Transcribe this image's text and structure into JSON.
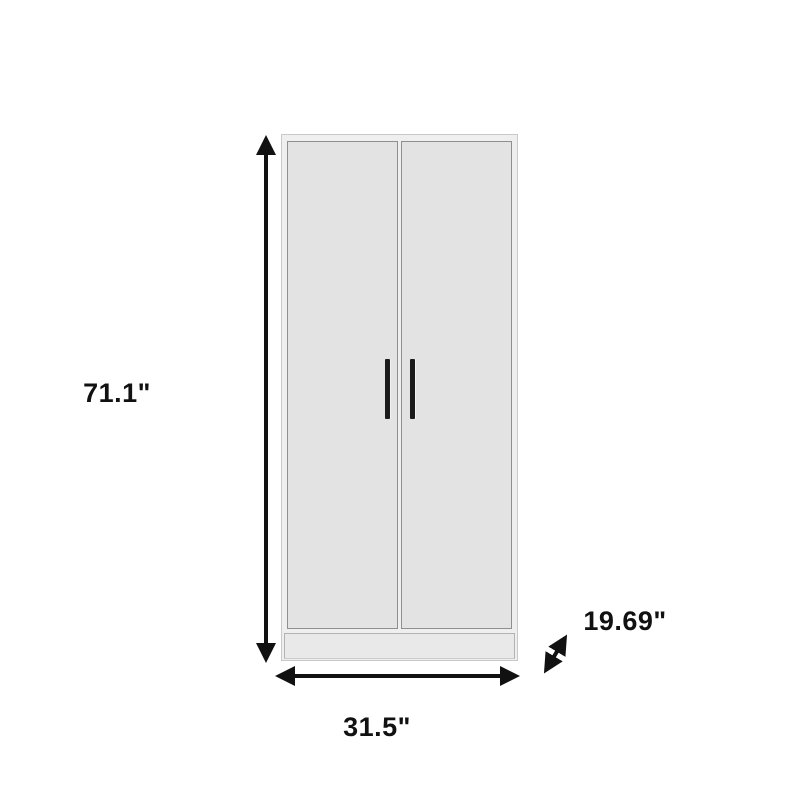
{
  "diagram": {
    "type": "product-dimension-diagram",
    "product": "two-door wardrobe cabinet",
    "background_color": "#ffffff",
    "arrow_color": "#111111",
    "label_color": "#111111",
    "wardrobe": {
      "body_color": "#efefef",
      "door_color": "#e3e3e3",
      "door_border_color": "#8f8f8f",
      "base_color": "#e9e9e9",
      "handle_color": "#1b1b1b"
    }
  },
  "dimensions": {
    "height": {
      "label": "71.1\"",
      "axis": "vertical"
    },
    "width": {
      "label": "31.5\"",
      "axis": "horizontal"
    },
    "depth": {
      "label": "19.69\"",
      "axis": "diagonal"
    }
  },
  "icons": {
    "height_arrow": "double-headed-arrow-vertical",
    "width_arrow": "double-headed-arrow-horizontal",
    "depth_arrow": "double-headed-arrow-diagonal"
  }
}
